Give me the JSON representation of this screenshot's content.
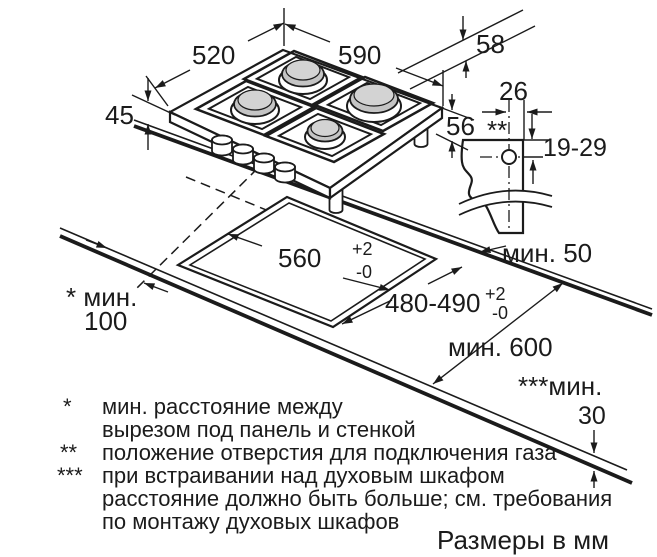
{
  "diagram": {
    "title_note": "Размеры в мм",
    "dims": {
      "hob_width": "520",
      "hob_length": "590",
      "rear_offset": "58",
      "height_above": "45",
      "depth_below": "56",
      "gas_hole_offset": "26",
      "gas_hole_depth": "19-29",
      "gas_hole_marker": "**",
      "cutout_width": "560",
      "cutout_width_sup": "+2",
      "cutout_width_sub": "-0",
      "cutout_depth": "480-490",
      "cutout_depth_sup": "+2",
      "cutout_depth_sub": "-0",
      "min_rear": "мин. 50",
      "min_side_label": "* мин.",
      "min_side_value": "100",
      "min_worktop": "мин. 600",
      "min_below_label": "***мин.",
      "min_below_value": "30"
    },
    "footnotes": {
      "sym1": "*",
      "f1a": "мин. расстояние между",
      "f1b": "вырезом под панель и стенкой",
      "sym2": "**",
      "f2a": "положение отверстия для подключения газа",
      "sym3": "***",
      "f3a": "при встраивании над духовым шкафом",
      "f3b": "расстояние должно быть больше; см. требования",
      "f3c": "по монтажу духовых шкафов"
    },
    "colors": {
      "line": "#1b1b1b",
      "burner_cap": "#c4c4c4",
      "burner_cap_top": "#d3d3d3"
    }
  }
}
